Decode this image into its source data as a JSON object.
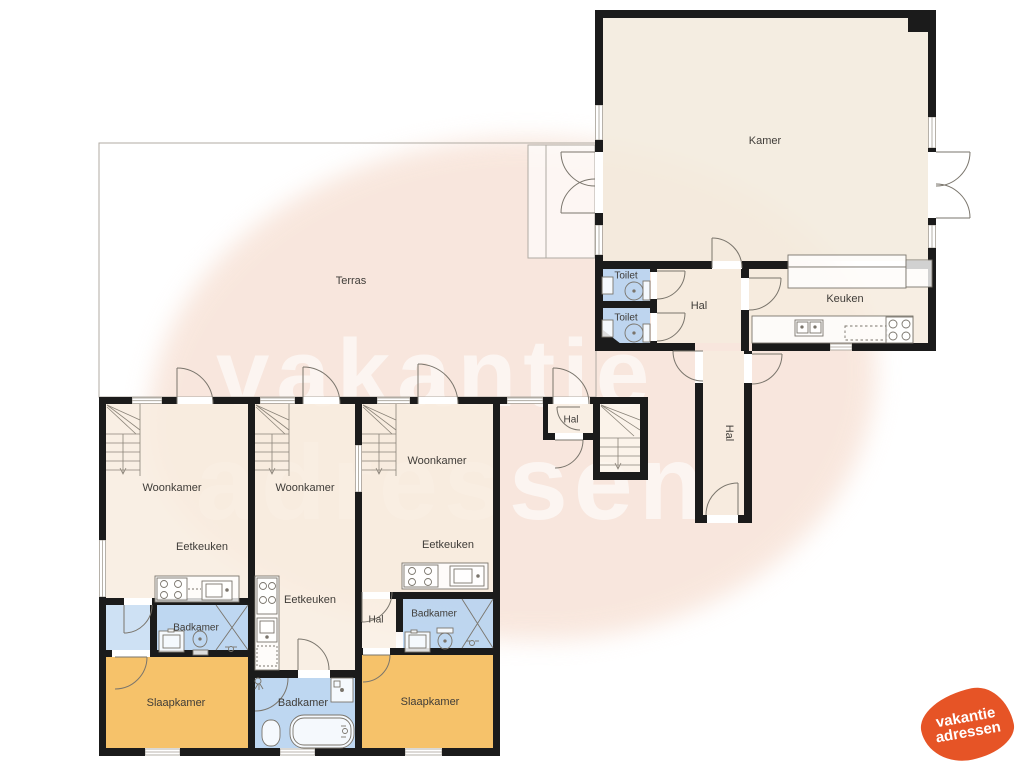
{
  "rooms": {
    "terras": "Terras",
    "kamer": "Kamer",
    "keuken": "Keuken",
    "hal_boven": "Hal",
    "toilet_1": "Toilet",
    "toilet_2": "Toilet",
    "hal_verdieping": "Hal",
    "hal_entree": "Hal",
    "unit1": {
      "woonkamer": "Woonkamer",
      "eetkeuken": "Eetkeuken",
      "badkamer": "Badkamer",
      "slaapkamer": "Slaapkamer"
    },
    "unit2": {
      "woonkamer": "Woonkamer",
      "eetkeuken": "Eetkeuken",
      "badkamer": "Badkamer"
    },
    "unit3": {
      "woonkamer": "Woonkamer",
      "eetkeuken": "Eetkeuken",
      "badkamer": "Badkamer",
      "slaapkamer": "Slaapkamer",
      "hal": "Hal"
    }
  },
  "watermark": {
    "line1": "vakantie",
    "line2": "adressen",
    "color": "rgba(255,255,255,0.6)"
  },
  "logo": {
    "line1": "vakantie",
    "line2": "adressen",
    "background": "#e65426",
    "text_color": "#ffffff"
  },
  "colors": {
    "wall": "#1b1b1b",
    "room_cream": "#f6ebdb",
    "wet_room_blue": "#b9d4f0",
    "closet_blue": "#cadef3",
    "bedroom_orange": "#f6bf62",
    "blob_peach": "#f7e1d5",
    "outline_gray": "#b0aba3"
  }
}
